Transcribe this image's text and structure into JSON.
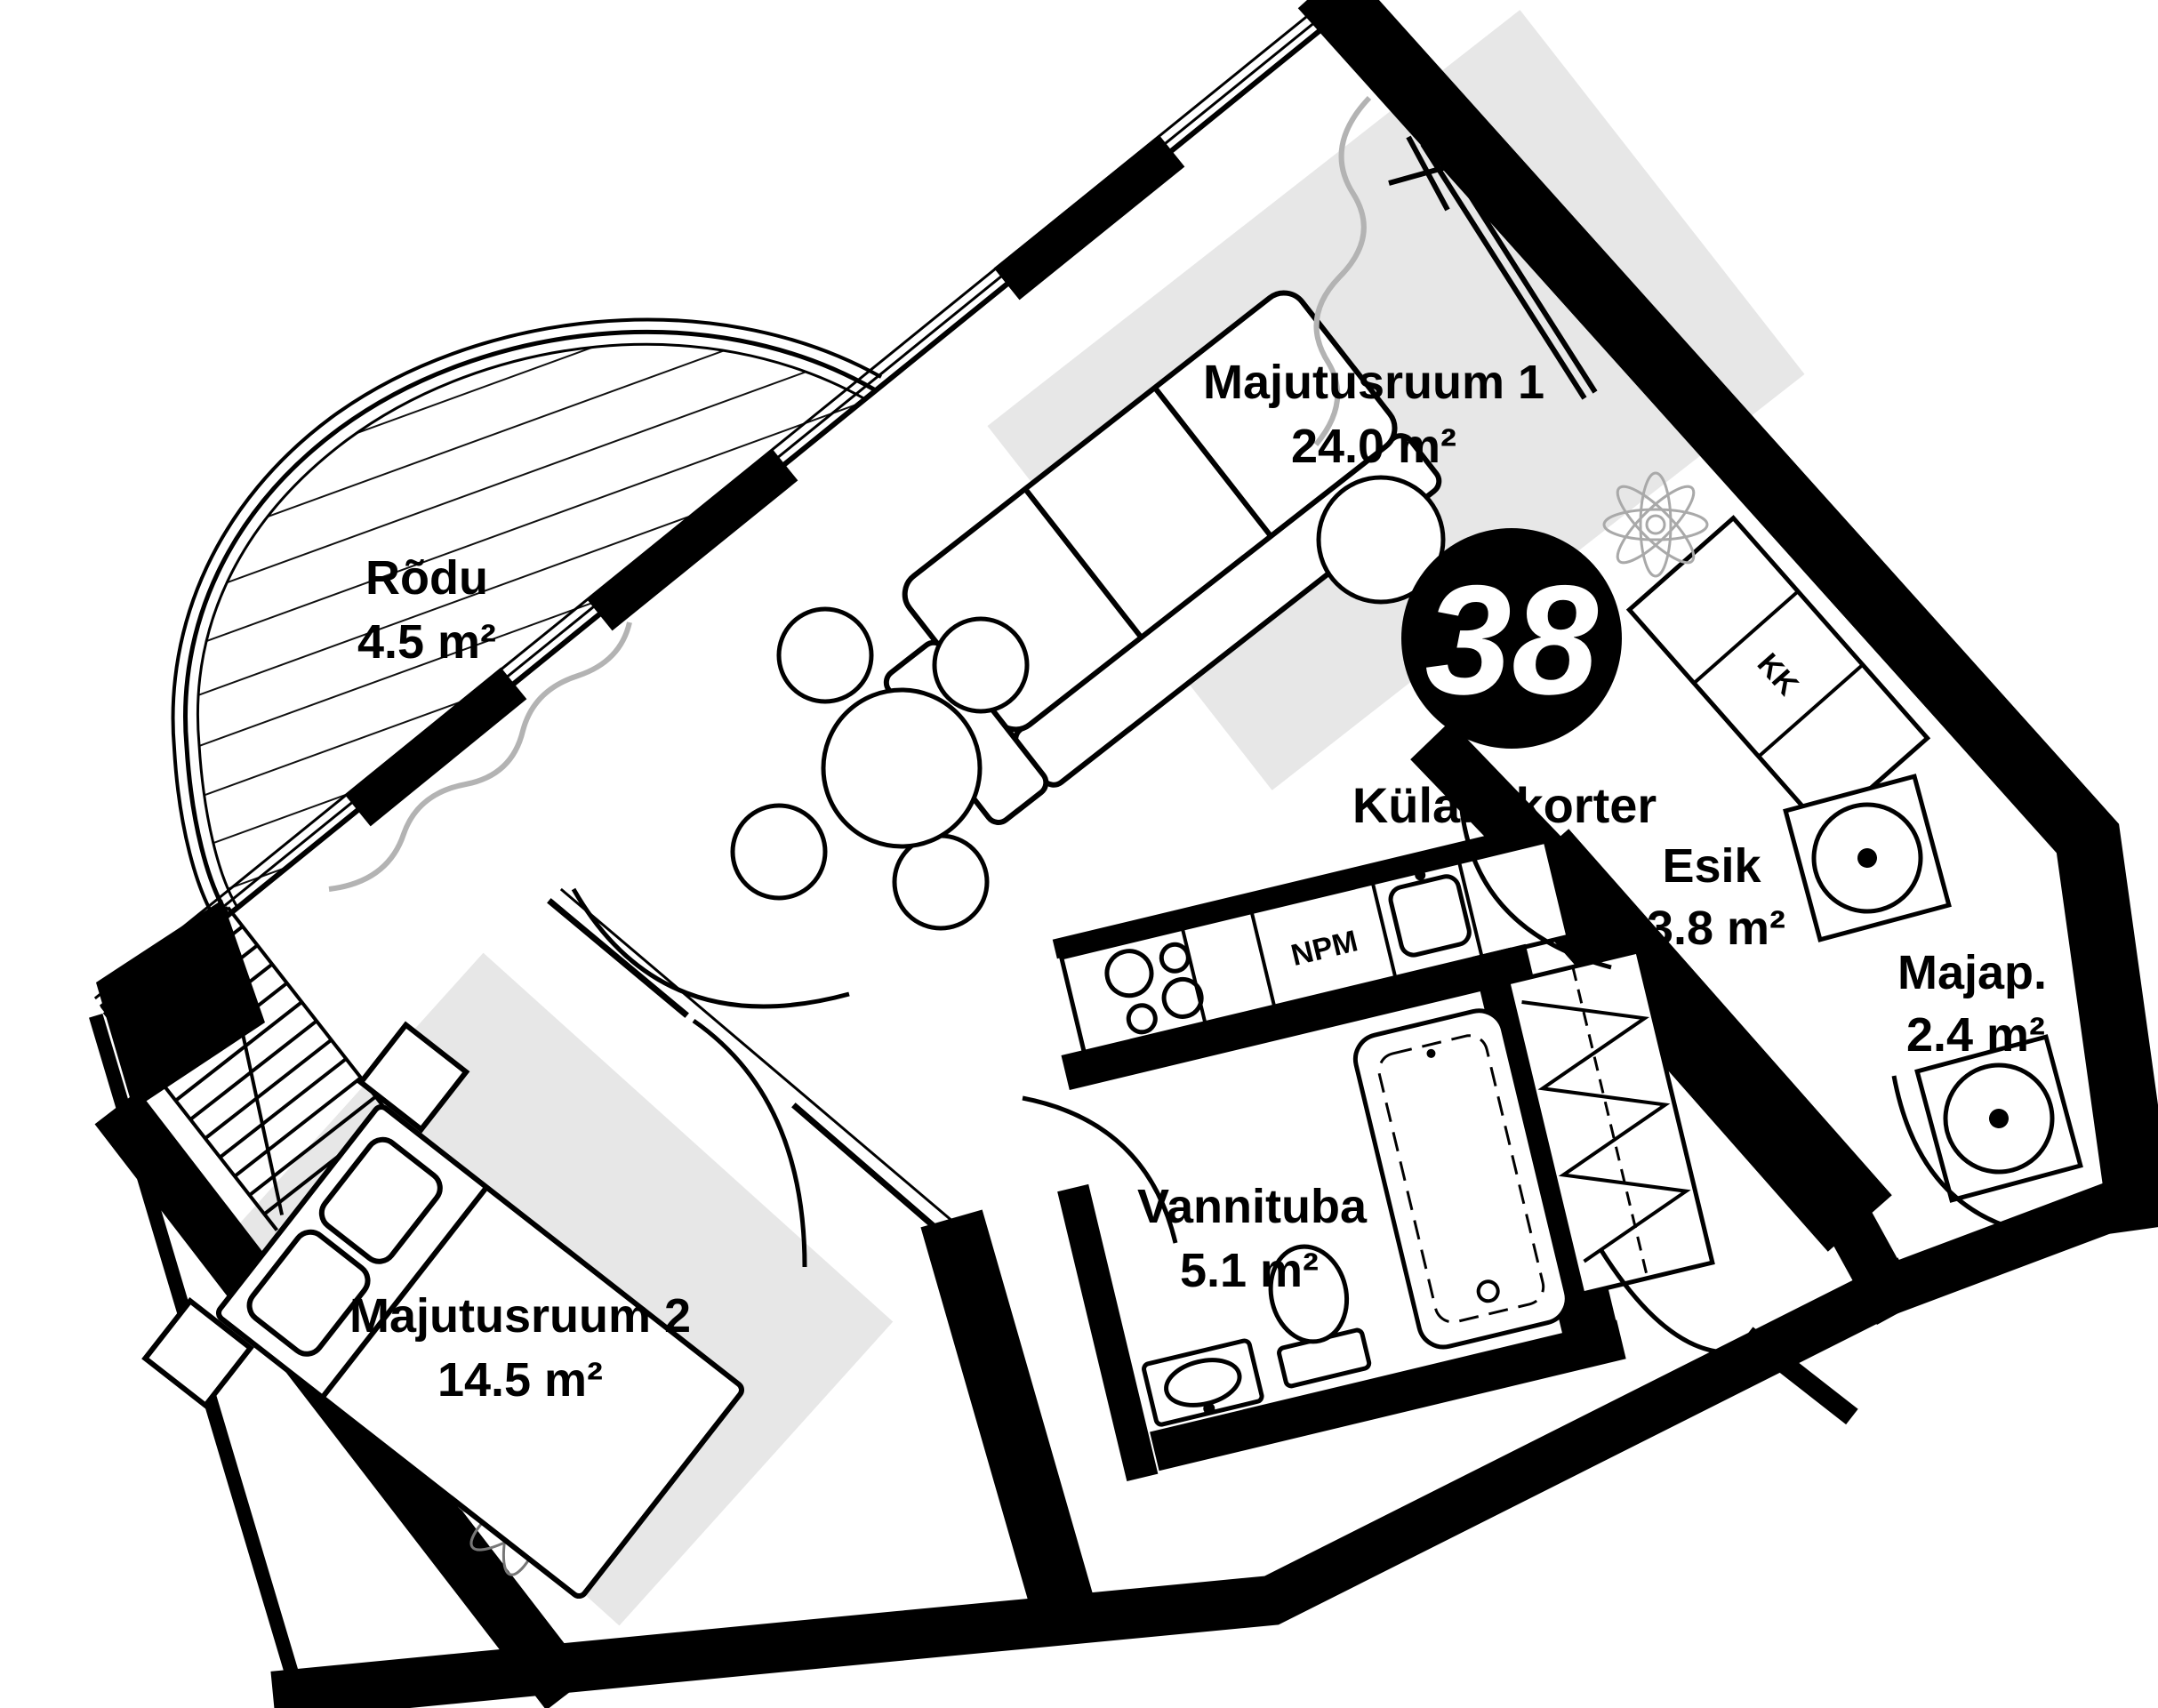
{
  "plan": {
    "badge": {
      "number": "38",
      "label": "Külaliskorter"
    },
    "rooms": [
      {
        "name": "Majutusruum 1",
        "area": "24.0 m²"
      },
      {
        "name": "Rõdu",
        "area": "4.5 m²"
      },
      {
        "name": "Esik",
        "area": "3.8 m²"
      },
      {
        "name": "Majap.",
        "area": "2.4 m²"
      },
      {
        "name": "Vannituba",
        "area": "5.1 m²"
      },
      {
        "name": "Majutusruum 2",
        "area": "14.5 m²"
      }
    ],
    "annotations": {
      "kitchenette": "KK",
      "dishwasher": "NPM"
    },
    "colors": {
      "walls": "#000000",
      "rug": "#e7e7e7",
      "curtain": "#b3b3b3",
      "badge_background": "#000000",
      "badge_number": "#ffffff"
    }
  }
}
